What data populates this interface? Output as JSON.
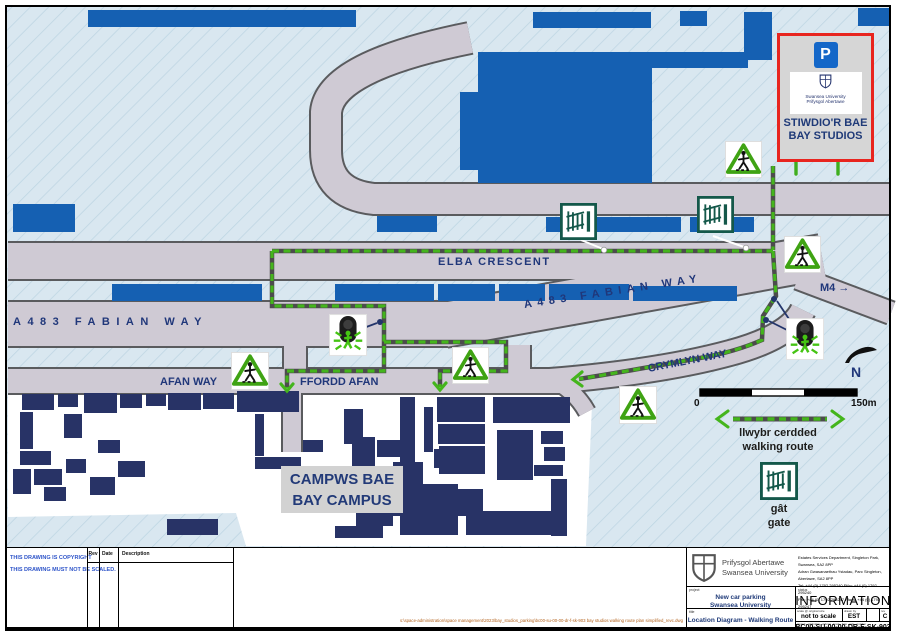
{
  "colors": {
    "building_blue": "#1560b2",
    "campus_navy": "#283366",
    "route_green": "#44b51c",
    "road_grey": "#cfcad4",
    "destination_border_red": "#e8251f",
    "label_navy": "#20377a",
    "background_hatch": "#d9e7f0"
  },
  "map": {
    "road_labels": {
      "fabian_left": "A483 FABIAN WAY",
      "fabian_right": "A483 FABIAN WAY",
      "elba": "ELBA CRESCENT",
      "m4": "M4 →",
      "afan": "AFAN WAY",
      "ffordd_afan": "FFORDD AFAN",
      "crymlyn": "CRYMLYN WAY"
    },
    "campus_label": {
      "line1": "CAMPWS BAE",
      "line2": "BAY CAMPUS"
    },
    "destination_box": {
      "parking_symbol": "P",
      "logo_line1": "Swansea University",
      "logo_line2": "Prifysgol Abertawe",
      "name_line1": "STIWDIO'R BAE",
      "name_line2": "BAY STUDIOS"
    },
    "north_label": "N",
    "scale_bar": {
      "zero": "0",
      "max": "150m"
    },
    "legend": {
      "route_label_cy": "llwybr cerdded",
      "route_label_en": "walking route",
      "gate_label_cy": "gât",
      "gate_label_en": "gate"
    }
  },
  "title_block": {
    "copyright_line1": "THIS DRAWING IS COPYRIGHT",
    "copyright_line2": "THIS DRAWING MUST NOT BE SCALED.",
    "revision_table": {
      "rev": "Rev",
      "date": "Date",
      "description": "Description"
    },
    "file_path": "s:\\space-administration\\space management\\2023\\bay_studios_parking\\bc00-su-00-00-dr-f-sk-903 bay studios walking route plan simplified_revc.dwg",
    "logo": {
      "line1": "Prifysgol Abertawe",
      "line2": "Swansea University"
    },
    "address": {
      "line1": "Estates Services Department, Singleton Park, Swansea, SA2 8PP",
      "line2": "Adran Gwasanaethau Ystadau, Parc Singleton, Abertawe, SA2 8PP",
      "line3": "Tel: +44 (0) 1792 295240      Ffôn: +44 (0) 1792 295240",
      "line4": "Fax: +44 (0) 1792 295247      Ffacs: +44 (0) 1792 295247"
    },
    "project": {
      "label": "project",
      "line1": "New car parking",
      "line2": "Swansea University"
    },
    "status": {
      "label": "status",
      "value": "INFORMATION"
    },
    "drawing_title": {
      "label": "title",
      "value": "Location Diagram - Walking Route"
    },
    "scale": {
      "label": "scale @ original size",
      "value": "not to scale"
    },
    "drawn": {
      "label": "drawn by",
      "value": "EST"
    },
    "revision": {
      "label": "rev",
      "value": "C"
    },
    "drawing_number": {
      "label": "project - originator - volume - level - type - role - number",
      "value": "BC00-SU-00-00-DR-F-SK-903"
    }
  }
}
